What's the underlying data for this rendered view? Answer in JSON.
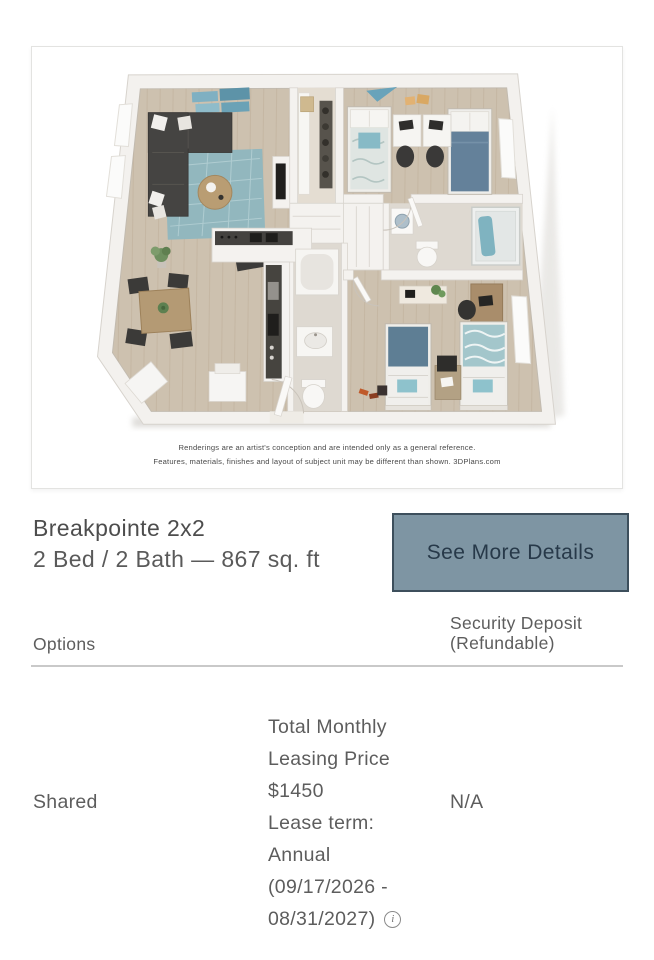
{
  "colors": {
    "button_bg": "#7E95A3",
    "button_border": "#3D4F5C",
    "button_text": "#273949",
    "heading_text": "#4D4D4D",
    "body_text": "#5D5D5D",
    "divider": "#C9C9C9",
    "card_border": "#E3E3E1"
  },
  "floorplan": {
    "alt": "3D rendered floor plan of a 2 bedroom, 2 bathroom apartment with living room, dining area, kitchen and closets",
    "disclaimer_lines": [
      "Renderings are an artist's conception and are intended only as a general reference.",
      "Features, materials, finishes and layout of subject unit may be different than shown. 3DPlans.com"
    ]
  },
  "listing": {
    "title": "Breakpointe 2x2",
    "subtitle": "2 Bed / 2 Bath — 867 sq. ft",
    "details_button_label": "See More Details"
  },
  "options_table": {
    "options_header": "Options",
    "deposit_header_lines": [
      "Security Deposit",
      "(Refundable)"
    ],
    "row": {
      "option_label": "Shared",
      "pricing_lines": [
        "Total Monthly",
        "Leasing Price",
        "$1450",
        "Lease term:",
        "Annual",
        "(09/17/2026 -"
      ],
      "pricing_last_line": "08/31/2027)",
      "info_icon_glyph": "i",
      "deposit_value": "N/A"
    }
  }
}
